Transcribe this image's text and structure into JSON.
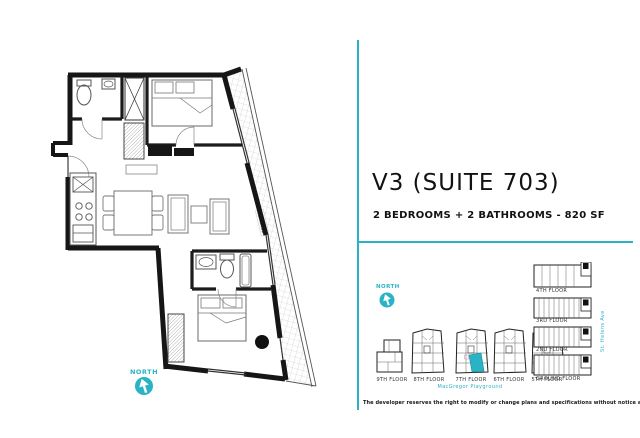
{
  "colors": {
    "accent": "#2ab3c4",
    "ink": "#161616"
  },
  "header": {
    "title": "V3 (SUITE 703)",
    "subtitle": "2 BEDROOMS + 2 BATHROOMS - 820 SF"
  },
  "floorplan": {
    "north_label": "NORTH",
    "terrace_label": "TERRACE"
  },
  "keyplan": {
    "north_label": "NORTH",
    "tower_floors": [
      {
        "label": "9TH FLOOR",
        "highlighted": false
      },
      {
        "label": "8TH FLOOR",
        "highlighted": false
      },
      {
        "label": "7TH FLOOR",
        "highlighted": true
      },
      {
        "label": "6TH FLOOR",
        "highlighted": false
      },
      {
        "label": "5TH FLOOR",
        "highlighted": false
      }
    ],
    "podium_floors": [
      {
        "label": "4TH FLOOR"
      },
      {
        "label": "3RD FLOOR"
      },
      {
        "label": "2ND FLOOR"
      },
      {
        "label": "GROUND FLOOR"
      }
    ],
    "park_label": "MacGregor Playground",
    "street_label": "St. Helens Ave"
  },
  "footer": {
    "disclaimer": "The developer reserves the right to modify or change plans and specifications without notice as deemed necessary. E&OE."
  }
}
